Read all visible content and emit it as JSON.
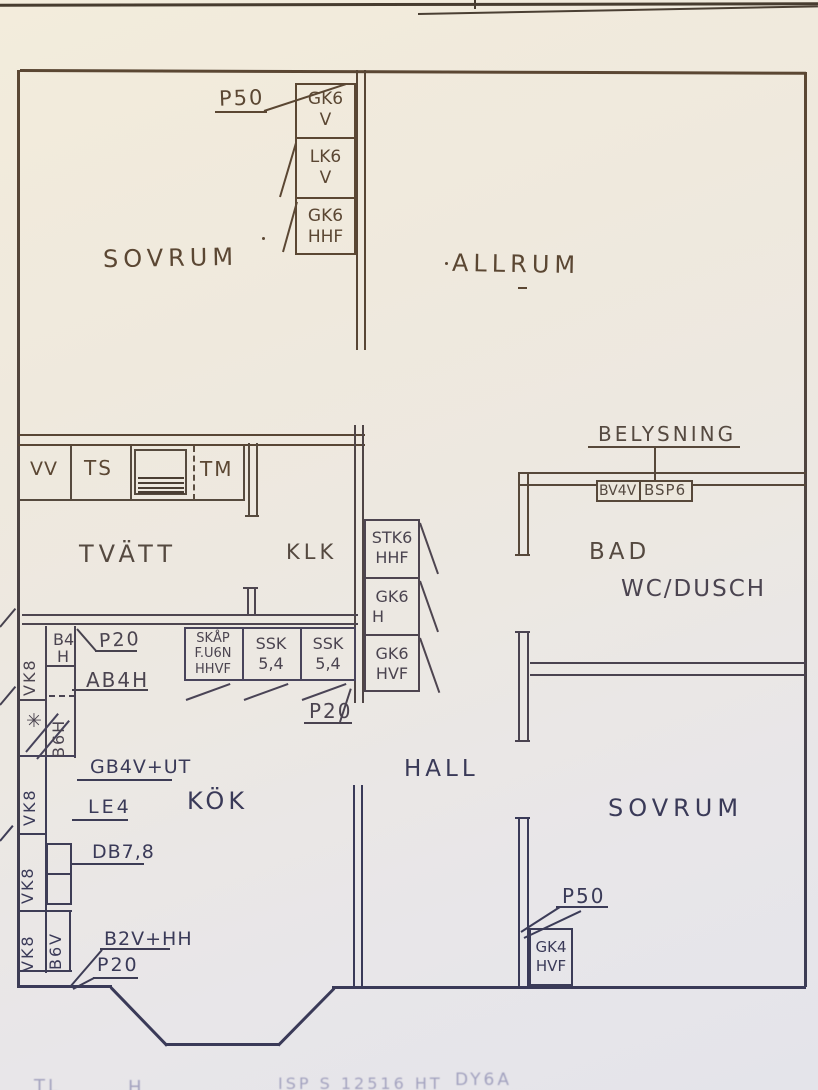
{
  "colors": {
    "paper": "#eee9df",
    "ink_brown": "#5b4733",
    "ink_mid_brown": "#554940",
    "ink_mid": "#4b4450",
    "ink_blue": "#3a3a58"
  },
  "rooms": {
    "sovrum_top": "SOVRUM",
    "allrum": "ALLRUM",
    "tvatt": "TVÄTT",
    "klk": "KLK",
    "bad": "BAD",
    "wc_dusch": "WC/DUSCH",
    "kok": "KÖK",
    "hall": "HALL",
    "sovrum_bottom": "SOVRUM"
  },
  "top_stack": {
    "callout": "P50",
    "boxes": [
      {
        "line1": "GK6",
        "line2": "V"
      },
      {
        "line1": "LK6",
        "line2": "V"
      },
      {
        "line1": "GK6",
        "line2": "HHF"
      }
    ]
  },
  "laundry": {
    "cells": [
      "VV",
      "TS",
      "TM"
    ]
  },
  "wardrobe_stack": {
    "boxes": [
      {
        "line1": "STK6",
        "line2": "HHF"
      },
      {
        "line1": "GK6",
        "line2": "H"
      },
      {
        "line1": "GK6",
        "line2": "HVF"
      }
    ],
    "callout": "P20"
  },
  "kitchen_row": {
    "boxes": [
      {
        "line1": "SKÅP",
        "line2": "F.U6N",
        "line3": "HHVF"
      },
      {
        "line1": "SSK",
        "line2": "5,4"
      },
      {
        "line1": "SSK",
        "line2": "5,4"
      }
    ]
  },
  "lighting": {
    "label": "BELYSNING",
    "circuits": [
      "BV4V",
      "BSP6"
    ]
  },
  "left_column": {
    "vk8": "VK8",
    "b4_top": "B4",
    "b4_bottom": "H",
    "b6h": "B6H",
    "b6v": "B6V",
    "star": "✳",
    "callouts": {
      "p20_top": "P20",
      "ab4h": "AB4H",
      "gb4v_ut": "GB4V+UT",
      "le4": "LE4",
      "db78": "DB7,8",
      "b2v_hh": "B2V+HH",
      "p20_bottom": "P20"
    }
  },
  "corner_cabinet": {
    "callout": "P50",
    "line1": "GK4",
    "line2": "HVF"
  },
  "footer_fragments": [
    "TL",
    "H",
    "ISP S 12516 HT",
    "DY6A"
  ]
}
